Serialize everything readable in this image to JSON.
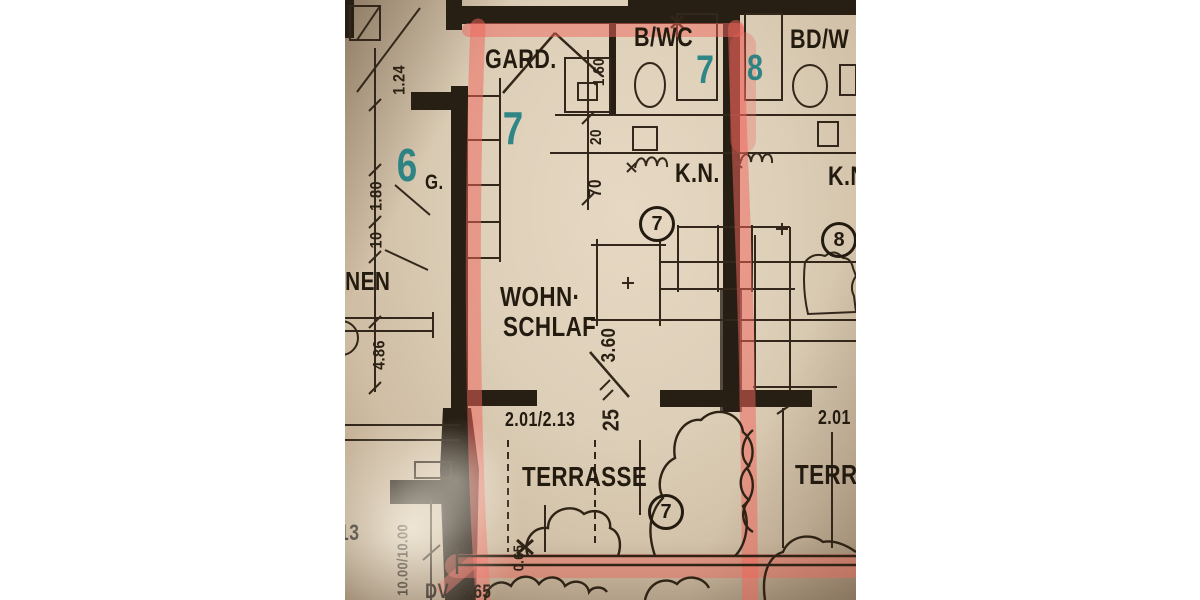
{
  "photo": {
    "description": "photographed architectural floor plan with one flat outlined in pink highlighter",
    "rooms": {
      "gard": "GARD.",
      "bwc": "B/WC",
      "bdw": "BD/W",
      "g": "G.",
      "kn_left": "K.N.",
      "kn_right": "K.N",
      "wohn": "WOHN·",
      "schlaf": "SCHLAF",
      "terrasse_left": "TERRASSE",
      "terrasse_right": "TERRA",
      "inen": "INEN",
      "dv": "DV"
    },
    "dims": {
      "d124": "1.24",
      "d180": "1.80",
      "d10": "10",
      "d486": "4.86",
      "d160": "1.60",
      "d20": "20",
      "d70": "70",
      "d360": "3.60",
      "d25": "25",
      "d201_213": "2.01/2.13",
      "d201": "2.01",
      "d065": "0.65",
      "d1000": "10.00/10.00",
      "d13": "13",
      "d665": "6.65"
    },
    "teal": {
      "gard": "7",
      "bwc": "7",
      "bdw": "8",
      "neighbor": "6"
    },
    "circled": {
      "kitchen": "7",
      "right_room": "8",
      "terrace": "7"
    },
    "colors": {
      "paper": "#ddcfb8",
      "ink": "#271e14",
      "highlight": "#ef655c",
      "teal_marker": "#187c7f",
      "margin": "#ffffff"
    }
  }
}
